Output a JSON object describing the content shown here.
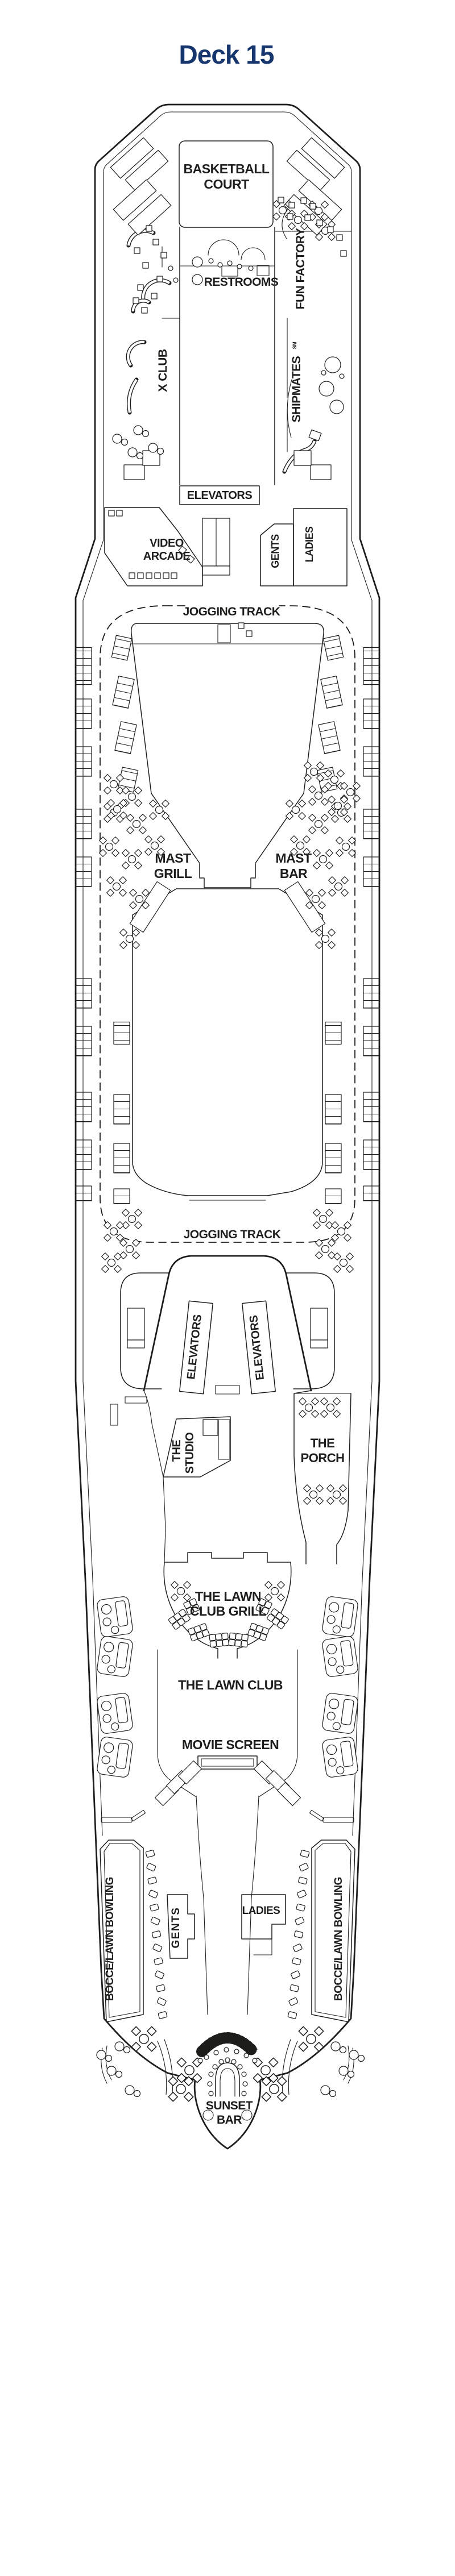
{
  "title": "Deck 15",
  "colors": {
    "title": "#17366e",
    "line": "#1d1d1b",
    "background": "#ffffff"
  },
  "labels": {
    "basketball_court": {
      "line1": "BASKETBALL",
      "line2": "COURT"
    },
    "restrooms": "RESTROOMS",
    "x_club": "X CLUB",
    "fun_factory": "FUN FACTORY",
    "shipmates": "SHIPMATES",
    "shipmates_mark": "SM",
    "elevators_top": "ELEVATORS",
    "video_arcade": {
      "line1": "VIDEO",
      "line2": "ARCADE"
    },
    "gents_top": "GENTS",
    "ladies_top": "LADIES",
    "jogging_track_top": "JOGGING TRACK",
    "jogging_track_bottom": "JOGGING TRACK",
    "mast_grill": {
      "line1": "MAST",
      "line2": "GRILL"
    },
    "mast_bar": {
      "line1": "MAST",
      "line2": "BAR"
    },
    "elevators_left": "ELEVATORS",
    "elevators_right": "ELEVATORS",
    "the_studio": {
      "line1": "THE",
      "line2": "STUDIO"
    },
    "the_porch": {
      "line1": "THE",
      "line2": "PORCH"
    },
    "lawn_club_grill": {
      "line1": "THE LAWN",
      "line2": "CLUB GRILL"
    },
    "lawn_club": "THE LAWN CLUB",
    "movie_screen": "MOVIE SCREEN",
    "bocce_left": "BOCCE/LAWN BOWLING",
    "bocce_right": "BOCCE/LAWN BOWLING",
    "gents_bottom": "GENTS",
    "ladies_bottom": "LADIES",
    "sunset_bar": {
      "line1": "SUNSET",
      "line2": "BAR"
    }
  }
}
